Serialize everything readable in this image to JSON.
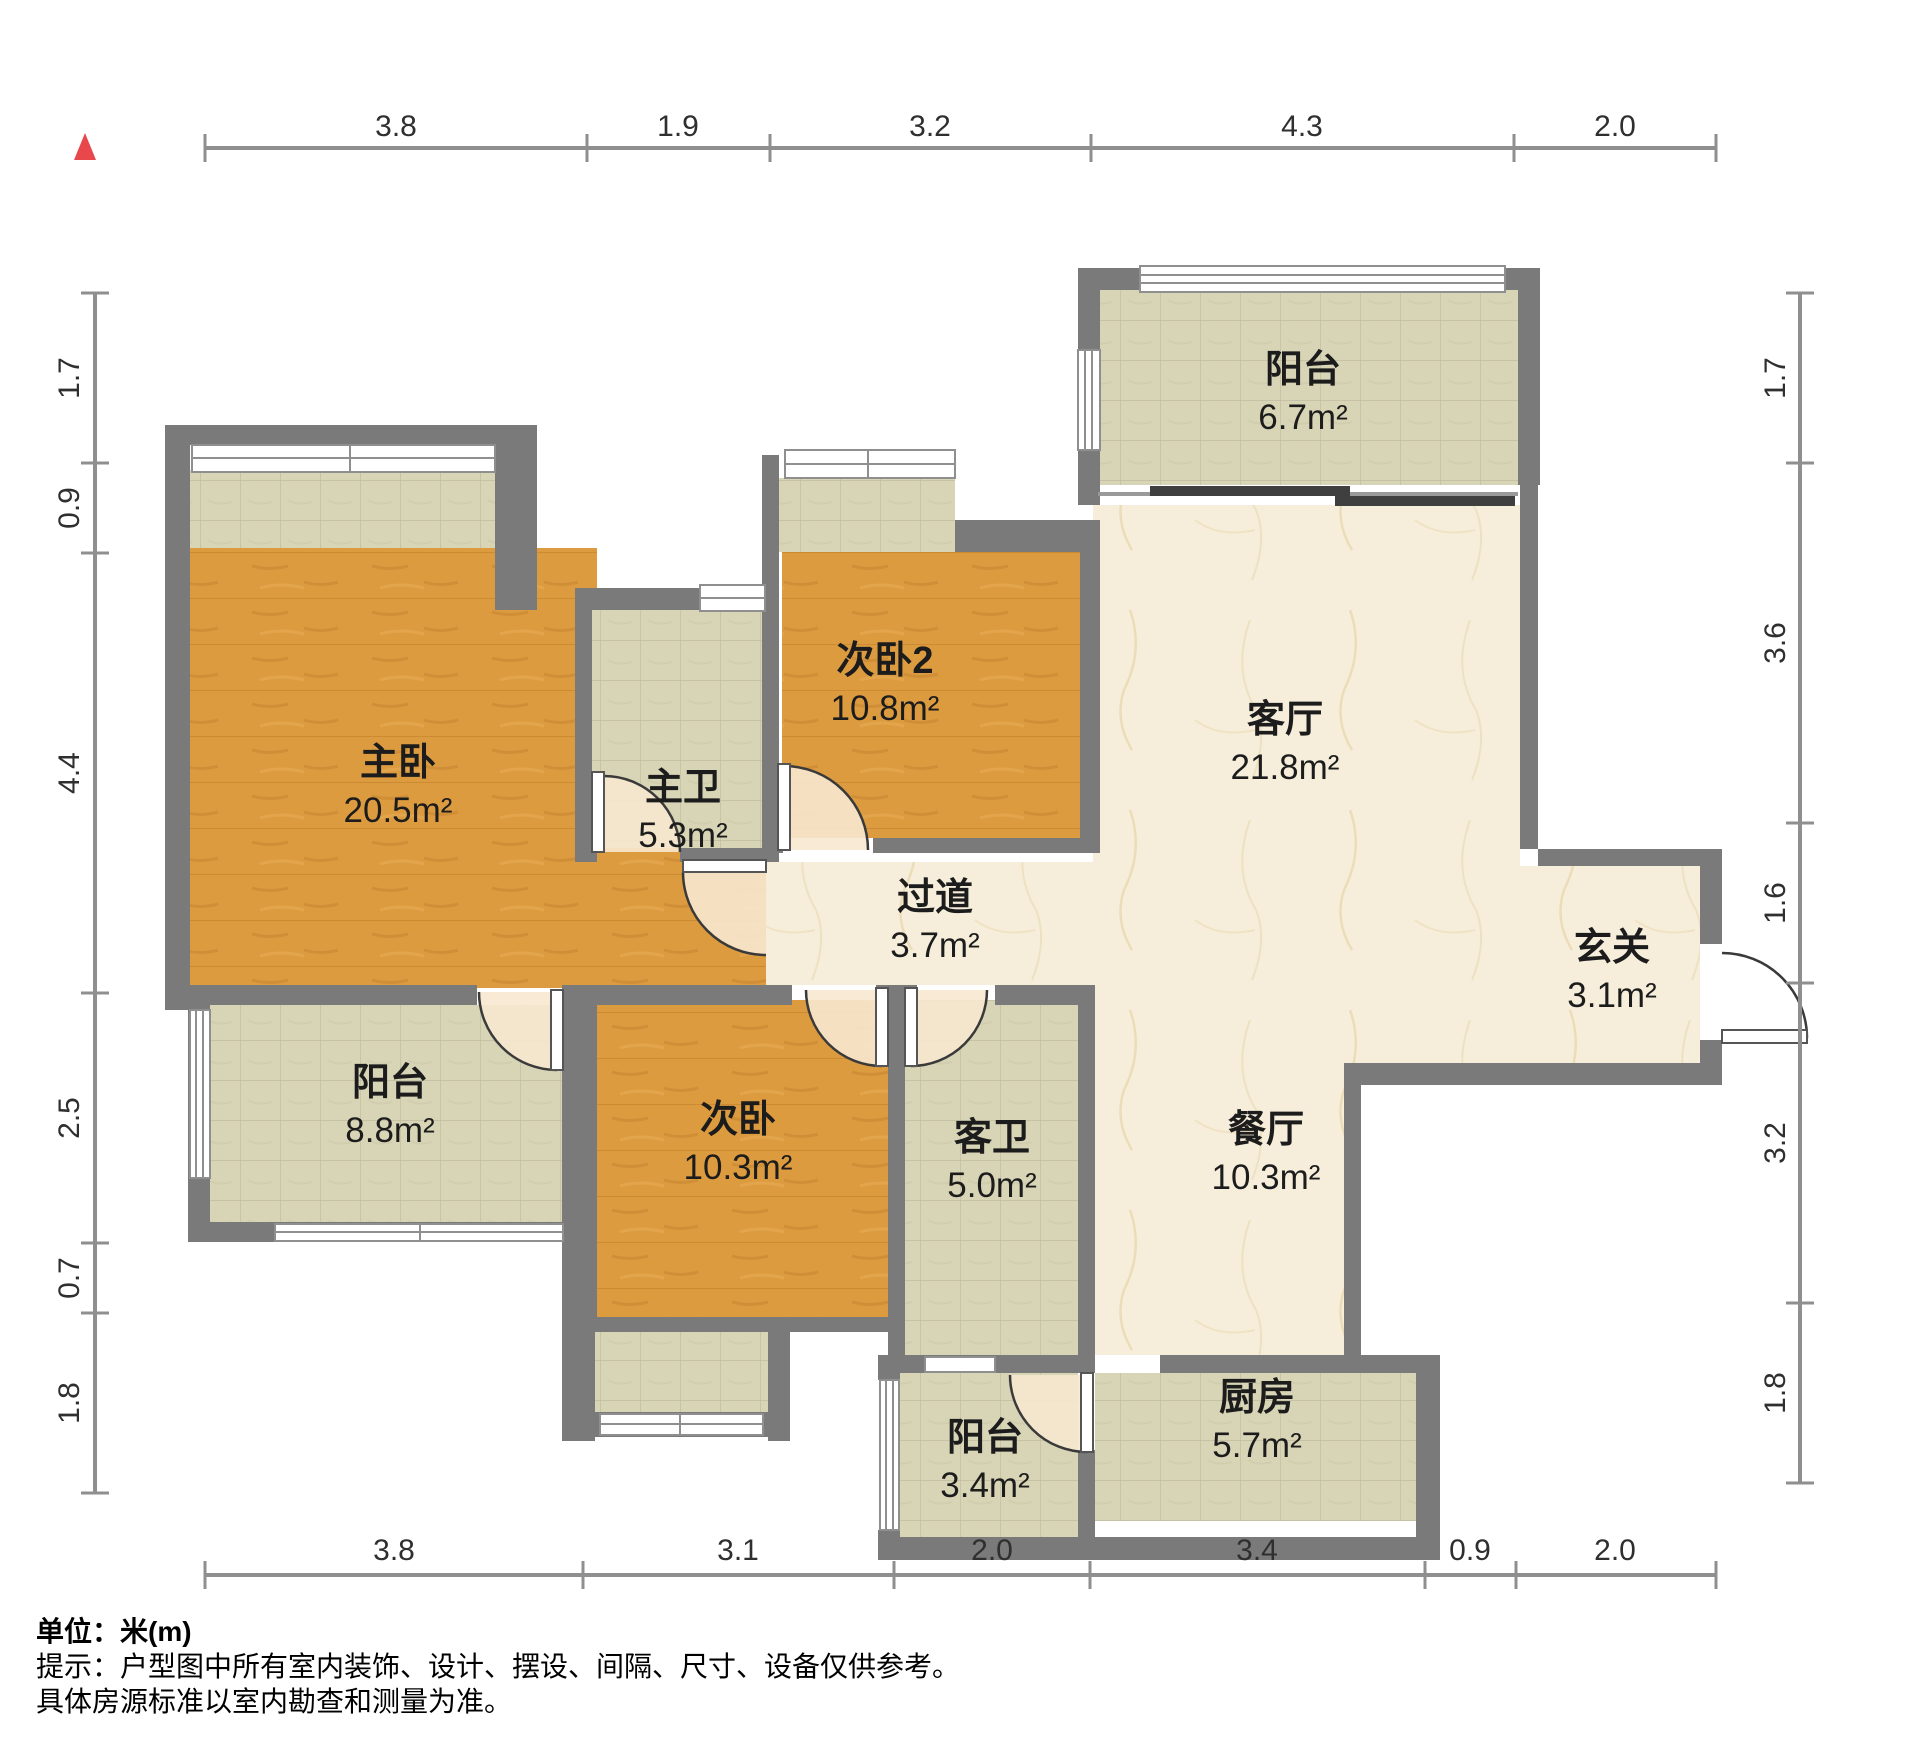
{
  "colors": {
    "wall": "#7a7a7a",
    "wood": "#dd9b40",
    "tile": "#d8d4b6",
    "marble": "#f6eedb",
    "swing": "#f7e8cf",
    "accent": "#e8474b",
    "dimline": "#8f8f8f",
    "text": "#1c1c1c"
  },
  "rooms": {
    "balcony_north": {
      "name": "阳台",
      "area": "6.7m²"
    },
    "living": {
      "name": "客厅",
      "area": "21.8m²"
    },
    "foyer": {
      "name": "玄关",
      "area": "3.1m²"
    },
    "master": {
      "name": "主卧",
      "area": "20.5m²"
    },
    "master_bath": {
      "name": "主卫",
      "area": "5.3m²"
    },
    "bed2": {
      "name": "次卧2",
      "area": "10.8m²"
    },
    "corridor": {
      "name": "过道",
      "area": "3.7m²"
    },
    "balcony_west": {
      "name": "阳台",
      "area": "8.8m²"
    },
    "bed": {
      "name": "次卧",
      "area": "10.3m²"
    },
    "guest_bath": {
      "name": "客卫",
      "area": "5.0m²"
    },
    "dining": {
      "name": "餐厅",
      "area": "10.3m²"
    },
    "balcony_south": {
      "name": "阳台",
      "area": "3.4m²"
    },
    "kitchen": {
      "name": "厨房",
      "area": "5.7m²"
    }
  },
  "dims": {
    "top": [
      "3.8",
      "1.9",
      "3.2",
      "4.3",
      "2.0"
    ],
    "bottom": [
      "3.8",
      "3.1",
      "2.0",
      "3.4",
      "0.9",
      "2.0"
    ],
    "left": [
      "1.7",
      "0.9",
      "4.4",
      "2.5",
      "0.7",
      "1.8"
    ],
    "right": [
      "1.7",
      "3.6",
      "1.6",
      "3.2",
      "1.8"
    ]
  },
  "notes": {
    "unit": "单位：米(m)",
    "tip": "提示：户型图中所有室内装饰、设计、摆设、间隔、尺寸、设备仅供参考。",
    "tip2": "具体房源标准以室内勘查和测量为准。"
  }
}
